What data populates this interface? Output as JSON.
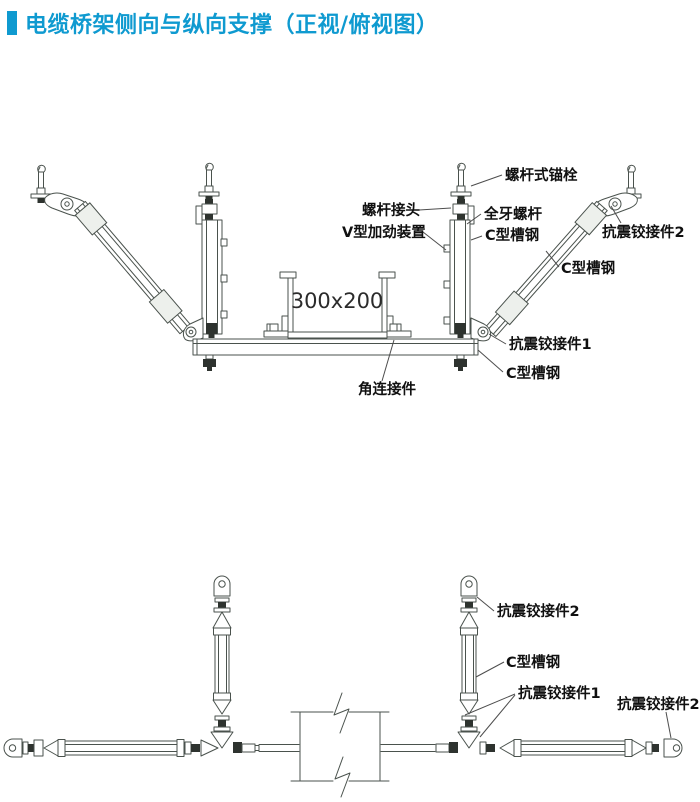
{
  "title": {
    "text": "电缆桥架侧向与纵向支撑（正视/俯视图）"
  },
  "colors": {
    "accent": "#0f9ad0",
    "line": "#4a524d",
    "dark": "#2e332f"
  },
  "front_view": {
    "tray_label": "300x200",
    "labels": {
      "anchor_bolt": "螺杆式锚栓",
      "rod_coupler": "螺杆接头",
      "threaded_rod": "全牙螺杆",
      "v_stiffener": "V型加劲装置",
      "channel_hanger": "C型槽钢",
      "hinge2": "抗震铰接件2",
      "channel_diagonal": "C型槽钢",
      "hinge1": "抗震铰接件1",
      "channel_rail": "C型槽钢",
      "corner_connector": "角连接件"
    }
  },
  "plan_view": {
    "labels": {
      "hinge2_top": "抗震铰接件2",
      "channel": "C型槽钢",
      "hinge1": "抗震铰接件1",
      "hinge2_right": "抗震铰接件2"
    }
  }
}
